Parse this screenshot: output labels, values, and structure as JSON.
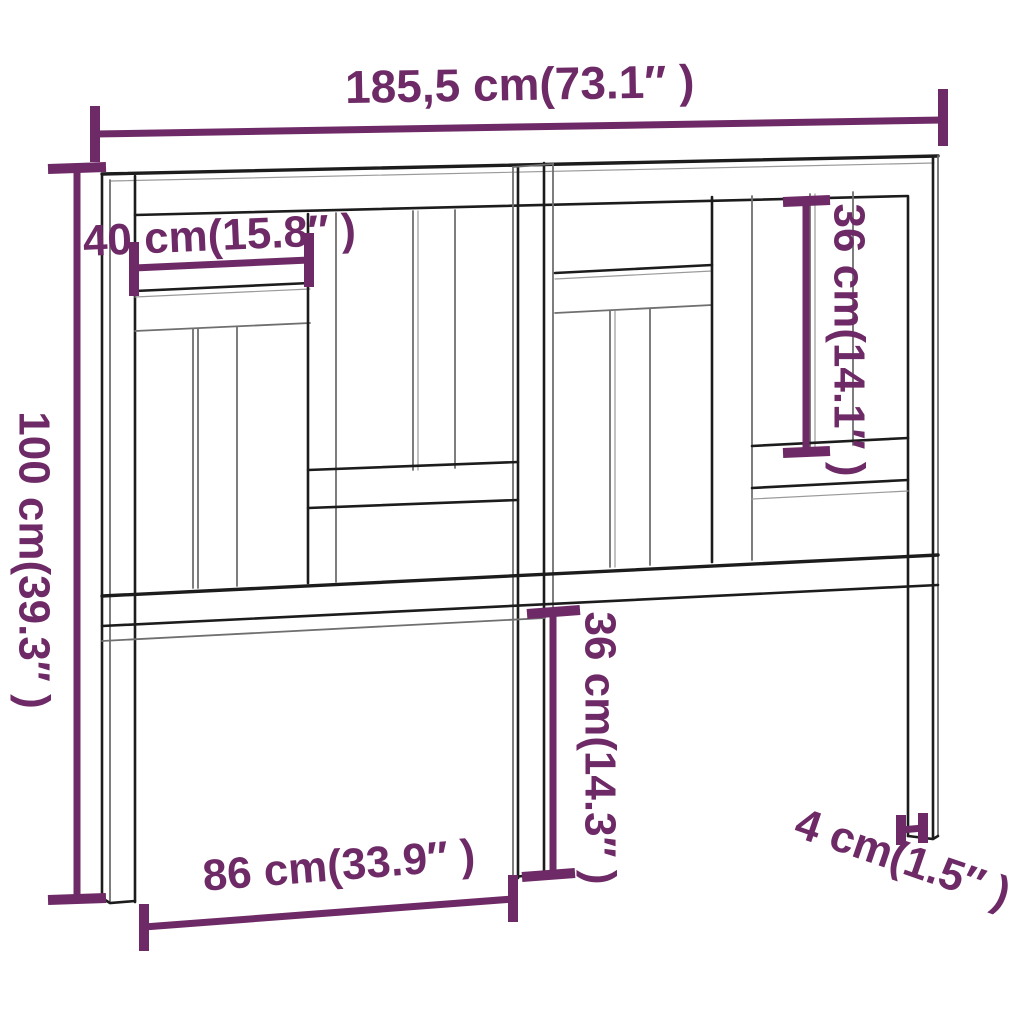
{
  "diagram": {
    "title": "headboard-dimension-diagram",
    "labels": {
      "total_width": "185,5 cm(73.1″ )",
      "upper_board_width": "40 cm(15.8″ )",
      "total_height": "100 cm(39.3″ )",
      "right_panel_height": "36 cm(14.1″ )",
      "center_lower_height": "36 cm(14.3″ )",
      "lower_width": "86 cm(33.9″ )",
      "leg_thickness": "4 cm(1.5″ )"
    }
  },
  "colors": {
    "accent": "#6e2a66",
    "line_dark": "#1c1c1c",
    "line_gray": "#6f6f6f",
    "background": "#ffffff"
  }
}
